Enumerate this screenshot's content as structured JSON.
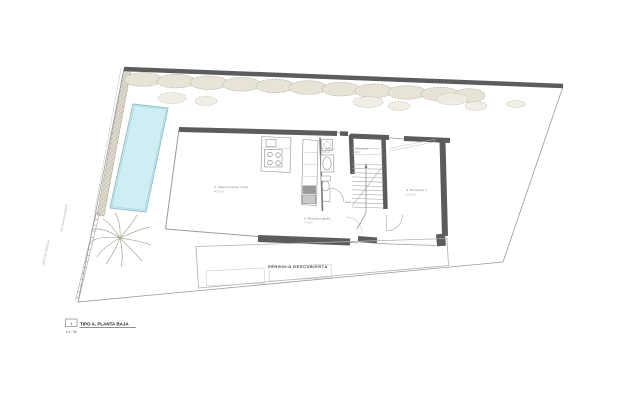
{
  "drawing": {
    "title_block": {
      "number": "1",
      "title": "TIPO A. PLANTA BAJA",
      "scale": "e 1 : 50"
    },
    "labels": {
      "pergola": "PÉRGOLA DESCUBIERTA",
      "rooms": [
        {
          "name": "S. Salón comedor cocina",
          "area": "44.35 m²"
        },
        {
          "name": "A. Baño 1",
          "area": "4.05 m²"
        },
        {
          "name": "E. Escalera",
          "area": "5.20 m²"
        },
        {
          "name": "A. Recibidor pasillo",
          "area": "7.10 m²"
        },
        {
          "name": "N. Dormitorio 1",
          "area": "13.25 m²"
        }
      ],
      "site_notes": [
        {
          "text": "VALLADO EXISTENTE"
        },
        {
          "text": "LÍMITE DE PARCELA"
        }
      ]
    },
    "colors": {
      "wall": "#5c5c5c",
      "line": "#9a9a9a",
      "pool_fill": "#cfeef4",
      "pool_stroke": "#8fc0cd",
      "hedge_fill": "#e7e4d7",
      "hedge_stroke": "#b2ad9b",
      "hatch_fill": "#ddd9cc",
      "paper": "#ffffff"
    }
  }
}
